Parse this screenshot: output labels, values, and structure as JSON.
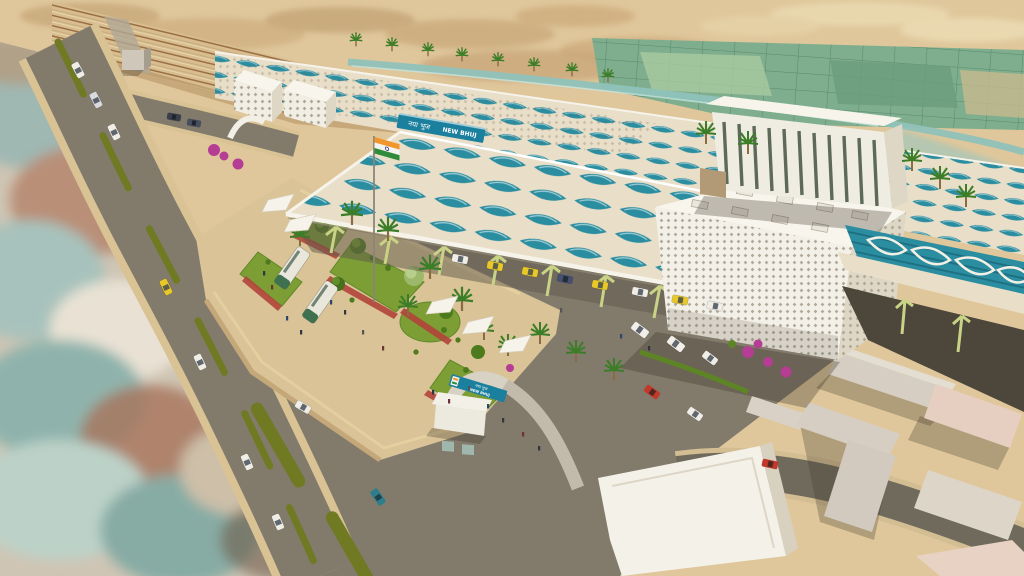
{
  "scene": {
    "description": "Aerial 3D architectural render of a redeveloped railway station: long platform canopy with teal leaf skylights, white diagrid lattice blocks, louvred office block, landscaped forecourt plaza with tensile canopies and national flag, entrance gate, desert town surroundings",
    "landmarks": [
      "railway-tracks",
      "platform-canopy",
      "station-main-roof",
      "lattice-parking-block",
      "louvred-office-block",
      "elevated-concourse",
      "forecourt-plaza",
      "entrance-gate",
      "security-booth",
      "national-flag",
      "bus-bay",
      "satellite-photo-inset",
      "existing-town-blocks",
      "farm-fields",
      "salt-flats"
    ]
  },
  "signs": {
    "roof_board": {
      "hindi": "नया भुज",
      "english": "NEW BHUJ"
    },
    "gate_board": {
      "hindi": "नया भुज",
      "english": "NEW BHUJ"
    }
  },
  "colors": {
    "sand": "#dfc79b",
    "desert_patch": "#c6a678",
    "fields_green": "#7fae8e",
    "canal_teal": "#8fc2ba",
    "road": "#827b6c",
    "road_dark": "#6f6a5c",
    "kerb": "#d9c294",
    "median_green": "#6f7a22",
    "plaza_paving": "#d9c397",
    "lawn": "#7d9d35",
    "flower_red": "#b2453a",
    "bougainvillea": "#b53d93",
    "palm_green": "#3c7d28",
    "roof_cream": "#e9dfc9",
    "skylight_teal": "#2b8da0",
    "lattice_white": "#f3f0e7",
    "slit_glass": "#5d6a57",
    "strut_yellow": "#c9d386",
    "sign_teal": "#1b7f9e",
    "flag_saffron": "#f1962d",
    "flag_white": "#f5f3ee",
    "flag_green": "#2e8b3a",
    "taxi_yellow": "#e8c929",
    "bus_green": "#3f7050",
    "car_white": "#f0ede6",
    "car_red": "#c0392b",
    "car_teal": "#2e7d8c",
    "building_beige": "#d6cec2",
    "building_pink": "#e6cfc0",
    "shadow": "#4c463b"
  }
}
